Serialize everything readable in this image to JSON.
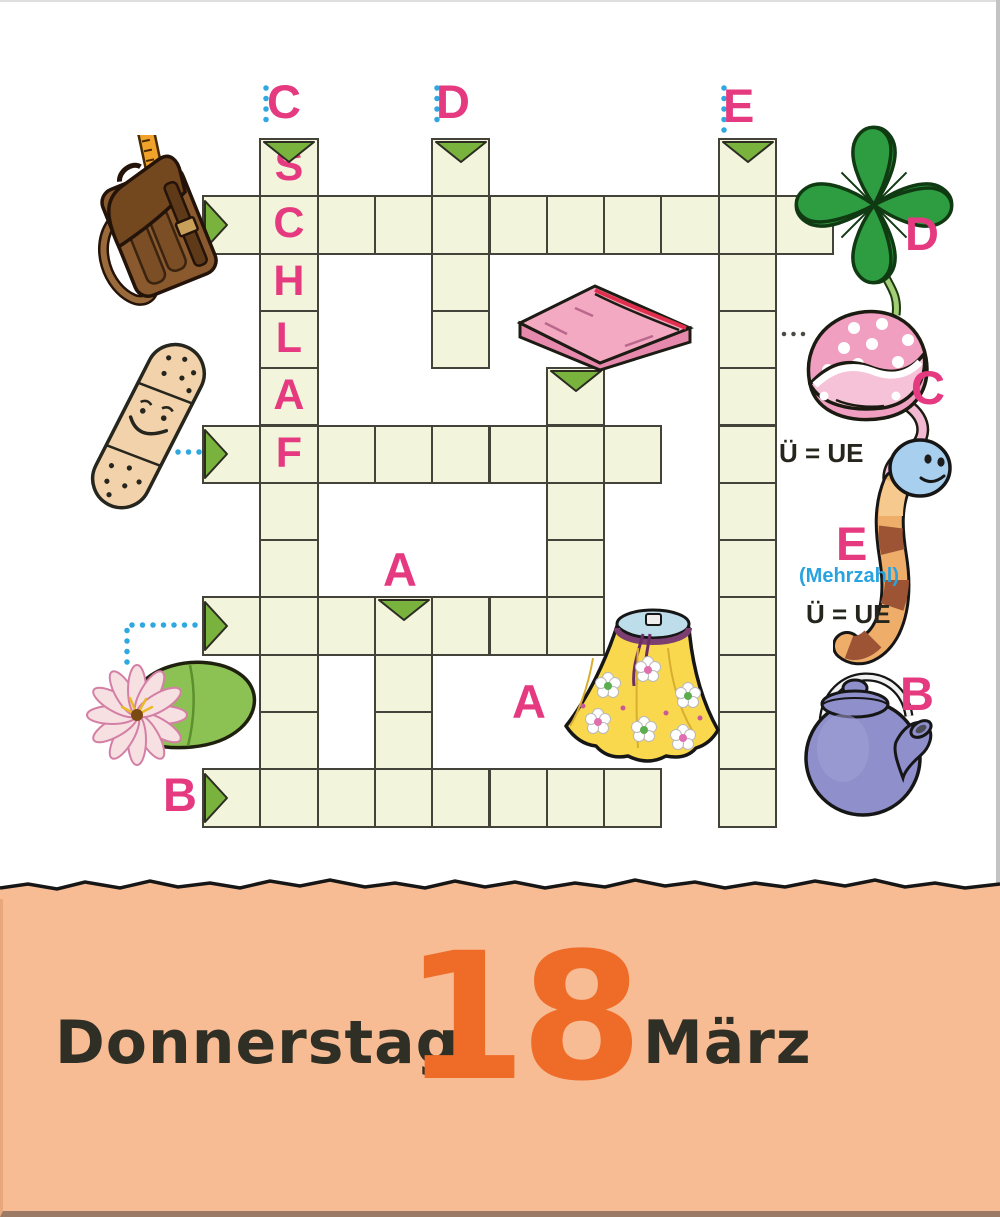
{
  "puzzle": {
    "cell_size": 57.3,
    "origin_x": 202,
    "origin_y": 138,
    "solution_letters": "SCHLAF",
    "runs": [
      {
        "word_for": "school-satchel",
        "dir": "h",
        "col": 0,
        "row": 1,
        "len": 11,
        "arrow": true
      },
      {
        "word_for": "plaster",
        "dir": "h",
        "col": 0,
        "row": 5,
        "len": 8,
        "arrow": true
      },
      {
        "word_for": "water-lily",
        "dir": "h",
        "col": 0,
        "row": 8,
        "len": 7,
        "arrow": true
      },
      {
        "word_for": "teapot",
        "dir": "h",
        "col": 0,
        "row": 11,
        "len": 8,
        "arrow": true
      },
      {
        "word_for": "nightcap",
        "dir": "v",
        "col": 1,
        "row": 0,
        "len": 12,
        "arrow": true,
        "letters": "SCHLAF"
      },
      {
        "word_for": "four-leaf-clover",
        "dir": "v",
        "col": 4,
        "row": 0,
        "len": 4,
        "arrow": true
      },
      {
        "word_for": "earthworm",
        "dir": "v",
        "col": 9,
        "row": 0,
        "len": 12,
        "arrow": true
      },
      {
        "word_for": "folded-blanket",
        "dir": "v",
        "col": 6,
        "row": 4,
        "len": 5,
        "arrow": true
      },
      {
        "word_for": "flowered-skirt",
        "dir": "v",
        "col": 3,
        "row": 8,
        "len": 4,
        "arrow": true
      }
    ],
    "clue_labels": {
      "top_c": "C",
      "top_d": "D",
      "top_e": "E",
      "mid_a": "A",
      "row_b": "B",
      "clover_d": "D",
      "hat_c": "C",
      "worm_e": "E",
      "teapot_b": "B",
      "skirt_a": "A"
    },
    "hints": {
      "hat_umlaut": "Ü = UE",
      "worm_plural": "(Mehrzahl)",
      "worm_umlaut": "Ü = UE"
    },
    "illustrations": [
      "school-satchel",
      "plaster",
      "water-lily",
      "folded-blanket",
      "four-leaf-clover",
      "nightcap",
      "earthworm",
      "flowered-skirt",
      "teapot"
    ]
  },
  "footer": {
    "weekday": "Donnerstag",
    "day": "18",
    "month": "März"
  },
  "colors": {
    "cell_fill": "#f2f5db",
    "cell_border": "#43433a",
    "arrow_green": "#79b33e",
    "clue_pink": "#e63a80",
    "connector_blue": "#2fa7e0",
    "hint_blue": "#29a3df",
    "footer_bg": "#f8bc95",
    "day_orange": "#ee6b28"
  }
}
